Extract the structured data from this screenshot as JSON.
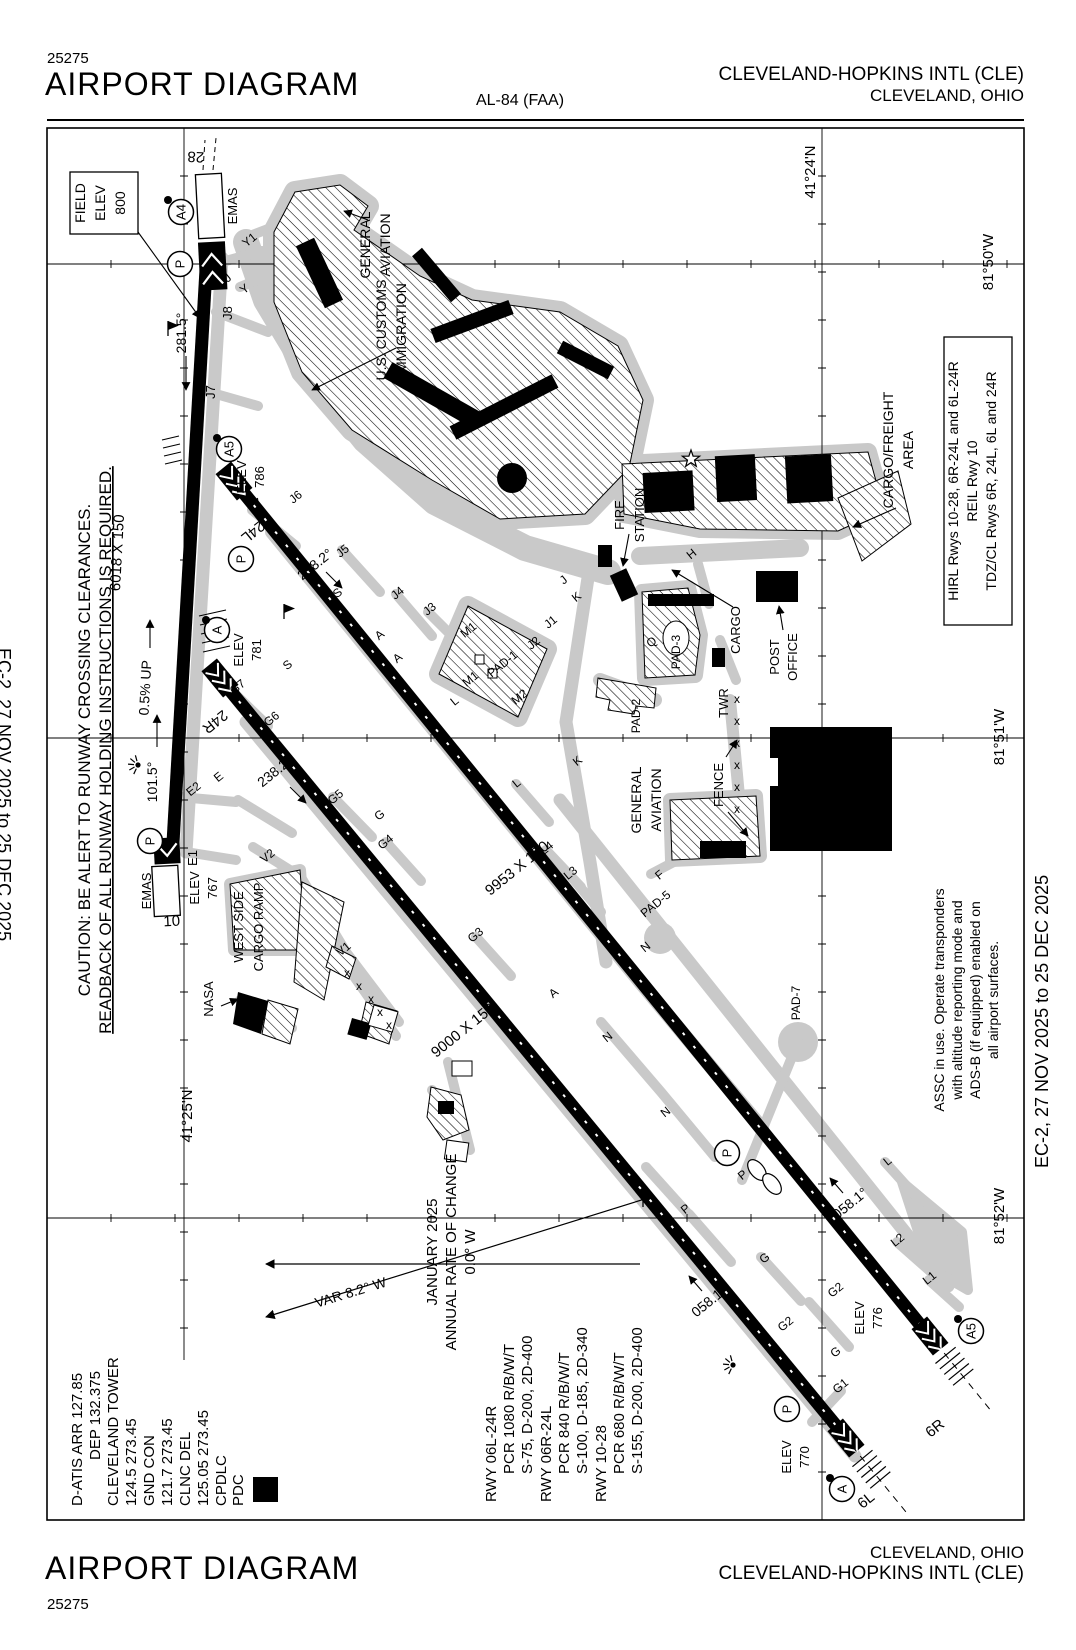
{
  "header": {
    "chart_number": "25275",
    "title": "AIRPORT DIAGRAM",
    "procedure": "AL-84 (FAA)",
    "airport": "CLEVELAND-HOPKINS INTL (CLE)",
    "city": "CLEVELAND, OHIO"
  },
  "footer": {
    "title": "AIRPORT DIAGRAM",
    "chart_number": "25275",
    "city": "CLEVELAND, OHIO",
    "airport": "CLEVELAND-HOPKINS INTL (CLE)"
  },
  "margins": {
    "left": "EC-2,  27 NOV 2025  to  25 DEC 2025",
    "right": "EC-2,  27 NOV 2025  to  25 DEC 2025"
  },
  "caution": {
    "lines": [
      {
        "t": "CAUTION: BE ALERT TO RUNWAY CROSSING CLEARANCES.",
        "x": 90,
        "y": 750,
        "fs": 17
      },
      {
        "t": "READBACK OF ALL RUNWAY HOLDING INSTRUCTIONS IS REQUIRED.",
        "x": 111,
        "y": 750,
        "fs": 17,
        "u": true
      }
    ]
  },
  "comms": {
    "lines": [
      {
        "t": "D-ATIS ARR 127.85",
        "x": 82,
        "y": 1506,
        "a": "s",
        "fs": 15
      },
      {
        "t": "DEP 132.375",
        "x": 100,
        "y": 1460,
        "a": "s",
        "fs": 15
      },
      {
        "t": "CLEVELAND TOWER",
        "x": 118,
        "y": 1506,
        "a": "s",
        "fs": 15
      },
      {
        "t": "124.5  273.45",
        "x": 136,
        "y": 1506,
        "a": "s",
        "fs": 15
      },
      {
        "t": "GND CON",
        "x": 154,
        "y": 1506,
        "a": "s",
        "fs": 15
      },
      {
        "t": "121.7  273.45",
        "x": 172,
        "y": 1506,
        "a": "s",
        "fs": 15
      },
      {
        "t": "CLNC DEL",
        "x": 190,
        "y": 1506,
        "a": "s",
        "fs": 15
      },
      {
        "t": "125.05  273.45",
        "x": 208,
        "y": 1506,
        "a": "s",
        "fs": 15
      },
      {
        "t": "CPDLC",
        "x": 226,
        "y": 1506,
        "a": "s",
        "fs": 15
      },
      {
        "t": "PDC",
        "x": 243,
        "y": 1506,
        "a": "s",
        "fs": 15
      }
    ],
    "pdc_symbol": "D"
  },
  "runway_data": {
    "lines": [
      {
        "t": "RWY 06L-24R",
        "x": 496,
        "y": 1502,
        "a": "s",
        "fs": 15
      },
      {
        "t": "PCR 1080 R/B/W/T",
        "x": 514,
        "y": 1474,
        "a": "s",
        "fs": 15
      },
      {
        "t": "S-75, D-200, 2D-400",
        "x": 532,
        "y": 1474,
        "a": "s",
        "fs": 15
      },
      {
        "t": "RWY 06R-24L",
        "x": 551,
        "y": 1502,
        "a": "s",
        "fs": 15
      },
      {
        "t": "PCR 840 R/B/W/T",
        "x": 569,
        "y": 1474,
        "a": "s",
        "fs": 15
      },
      {
        "t": "S-100, D-185, 2D-340",
        "x": 587,
        "y": 1474,
        "a": "s",
        "fs": 15
      },
      {
        "t": "RWY 10-28",
        "x": 606,
        "y": 1502,
        "a": "s",
        "fs": 15
      },
      {
        "t": "PCR 680 R/B/W/T",
        "x": 624,
        "y": 1474,
        "a": "s",
        "fs": 15
      },
      {
        "t": "S-155, D-200, 2D-400",
        "x": 642,
        "y": 1474,
        "a": "s",
        "fs": 15
      }
    ]
  },
  "variation": {
    "lines": [
      {
        "t": "JANUARY 2025",
        "x": 437,
        "y": 1252,
        "fs": 15
      },
      {
        "t": "ANNUAL RATE OF CHANGE",
        "x": 456,
        "y": 1252,
        "fs": 15
      },
      {
        "t": "0.0° W",
        "x": 475,
        "y": 1252,
        "fs": 15
      },
      {
        "t": "VAR 8.2° W",
        "x": 352,
        "y": 1297,
        "r": -17,
        "fs": 14
      }
    ]
  },
  "lighting": {
    "lines": [
      {
        "t": "HIRL Rwys 10-28, 6R-24L and 6L-24R",
        "x": 958,
        "y": 481,
        "fs": 14
      },
      {
        "t": "REIL Rwy 10",
        "x": 977,
        "y": 481,
        "fs": 14
      },
      {
        "t": "TDZ/CL Rwys 6R, 24L, 6L and 24R",
        "x": 996,
        "y": 481,
        "fs": 14
      }
    ]
  },
  "assc": {
    "lines": [
      {
        "t": "ASSC in use. Operate transponders",
        "x": 944,
        "y": 1000,
        "fs": 14
      },
      {
        "t": "with altitude reporting mode and",
        "x": 962,
        "y": 1000,
        "fs": 14
      },
      {
        "t": "ADS-B (if equipped) enabled on",
        "x": 980,
        "y": 1000,
        "fs": 14
      },
      {
        "t": "all airport surfaces.",
        "x": 998,
        "y": 1000,
        "fs": 14
      }
    ]
  },
  "field_elev": {
    "lines": [
      {
        "t": "FIELD",
        "x": 85,
        "y": 203,
        "fs": 14
      },
      {
        "t": "ELEV",
        "x": 105,
        "y": 203,
        "fs": 14
      },
      {
        "t": "800",
        "x": 125,
        "y": 203,
        "fs": 14
      }
    ]
  },
  "map_labels": [
    {
      "t": "28",
      "x": 196,
      "y": 152,
      "r": 183,
      "fs": 15
    },
    {
      "t": "EMAS",
      "x": 237,
      "y": 206,
      "fs": 13
    },
    {
      "t": "J8",
      "x": 232,
      "y": 313,
      "fs": 13
    },
    {
      "t": "J7",
      "x": 215,
      "y": 392,
      "fs": 13
    },
    {
      "t": "Y1",
      "x": 252,
      "y": 243,
      "r": -39,
      "fs": 12
    },
    {
      "t": "J",
      "x": 230,
      "y": 281,
      "r": -39,
      "fs": 12
    },
    {
      "t": "Y",
      "x": 247,
      "y": 292,
      "r": -39,
      "fs": 12
    },
    {
      "t": "281.5°",
      "x": 186,
      "y": 333,
      "fs": 14
    },
    {
      "t": "GENERAL",
      "x": 370,
      "y": 245,
      "fs": 14
    },
    {
      "t": "AVIATION",
      "x": 390,
      "y": 245,
      "fs": 14
    },
    {
      "t": "U.S. CUSTOMS",
      "x": 386,
      "y": 330,
      "fs": 14
    },
    {
      "t": "IMMIGRATION",
      "x": 406,
      "y": 330,
      "fs": 14
    },
    {
      "t": "ELEV",
      "x": 246,
      "y": 477,
      "fs": 13
    },
    {
      "t": "786",
      "x": 264,
      "y": 477,
      "fs": 13
    },
    {
      "t": "L7",
      "x": 258,
      "y": 508,
      "r": -39,
      "fs": 12
    },
    {
      "t": "24L",
      "x": 250,
      "y": 528,
      "r": 141,
      "fs": 15
    },
    {
      "t": "238.2°",
      "x": 318,
      "y": 568,
      "r": -39,
      "fs": 14
    },
    {
      "t": "J6",
      "x": 298,
      "y": 500,
      "r": -39,
      "fs": 12
    },
    {
      "t": "J5",
      "x": 345,
      "y": 554,
      "r": -39,
      "fs": 12
    },
    {
      "t": "J4",
      "x": 400,
      "y": 596,
      "r": -39,
      "fs": 12
    },
    {
      "t": "J3",
      "x": 432,
      "y": 612,
      "r": -39,
      "fs": 12
    },
    {
      "t": "S",
      "x": 340,
      "y": 596,
      "r": -39,
      "fs": 12
    },
    {
      "t": "S",
      "x": 290,
      "y": 668,
      "r": -39,
      "fs": 12
    },
    {
      "t": "6018 X 150",
      "x": 122,
      "y": 553,
      "r": -87,
      "fs": 15
    },
    {
      "t": "0.5% UP",
      "x": 150,
      "y": 688,
      "r": -87,
      "fs": 14
    },
    {
      "t": "ELEV",
      "x": 243,
      "y": 650,
      "fs": 13
    },
    {
      "t": "781",
      "x": 261,
      "y": 650,
      "fs": 13
    },
    {
      "t": "G7",
      "x": 240,
      "y": 690,
      "r": -39,
      "fs": 12
    },
    {
      "t": "24R",
      "x": 212,
      "y": 718,
      "r": 141,
      "fs": 15
    },
    {
      "t": "G6",
      "x": 274,
      "y": 722,
      "r": -39,
      "fs": 12
    },
    {
      "t": "238.2°",
      "x": 278,
      "y": 775,
      "r": -39,
      "fs": 14
    },
    {
      "t": "G5",
      "x": 338,
      "y": 800,
      "r": -39,
      "fs": 12
    },
    {
      "t": "G",
      "x": 382,
      "y": 818,
      "r": -39,
      "fs": 12
    },
    {
      "t": "E2",
      "x": 196,
      "y": 792,
      "r": -39,
      "fs": 12
    },
    {
      "t": "E",
      "x": 221,
      "y": 780,
      "r": -39,
      "fs": 12
    },
    {
      "t": "101.5°",
      "x": 157,
      "y": 782,
      "fs": 14
    },
    {
      "t": "EMAS",
      "x": 151,
      "y": 891,
      "fs": 13
    },
    {
      "t": "E1",
      "x": 197,
      "y": 858,
      "fs": 13
    },
    {
      "t": "ELEV",
      "x": 199,
      "y": 888,
      "fs": 13
    },
    {
      "t": "767",
      "x": 217,
      "y": 888,
      "fs": 13
    },
    {
      "t": "10",
      "x": 172,
      "y": 926,
      "r": -3,
      "fs": 15
    },
    {
      "t": "V2",
      "x": 270,
      "y": 859,
      "r": -39,
      "fs": 12
    },
    {
      "t": "WEST SIDE",
      "x": 243,
      "y": 927,
      "fs": 13
    },
    {
      "t": "CARGO RAMP",
      "x": 263,
      "y": 927,
      "fs": 13
    },
    {
      "t": "V1",
      "x": 346,
      "y": 952,
      "r": -39,
      "fs": 12
    },
    {
      "t": "NASA",
      "x": 213,
      "y": 999,
      "fs": 13
    },
    {
      "t": "9000 X 150",
      "x": 466,
      "y": 1034,
      "r": -39,
      "fs": 15
    },
    {
      "t": "9953 X 150",
      "x": 520,
      "y": 872,
      "r": -39,
      "fs": 15
    },
    {
      "t": "G4",
      "x": 388,
      "y": 845,
      "r": -39,
      "fs": 12
    },
    {
      "t": "G3",
      "x": 478,
      "y": 938,
      "r": -39,
      "fs": 12
    },
    {
      "t": "L4",
      "x": 549,
      "y": 851,
      "r": -39,
      "fs": 12
    },
    {
      "t": "L3",
      "x": 573,
      "y": 876,
      "r": -39,
      "fs": 12
    },
    {
      "t": "L",
      "x": 519,
      "y": 786,
      "r": -39,
      "fs": 12
    },
    {
      "t": "L",
      "x": 457,
      "y": 704,
      "r": -39,
      "fs": 12
    },
    {
      "t": "K",
      "x": 579,
      "y": 600,
      "r": -39,
      "fs": 12
    },
    {
      "t": "K",
      "x": 580,
      "y": 764,
      "r": -39,
      "fs": 12
    },
    {
      "t": "J",
      "x": 566,
      "y": 583,
      "r": -39,
      "fs": 12
    },
    {
      "t": "J2",
      "x": 536,
      "y": 646,
      "r": -39,
      "fs": 12
    },
    {
      "t": "J1",
      "x": 553,
      "y": 625,
      "r": -39,
      "fs": 12
    },
    {
      "t": "M1",
      "x": 471,
      "y": 633,
      "r": -39,
      "fs": 12
    },
    {
      "t": "M1",
      "x": 473,
      "y": 682,
      "r": -39,
      "fs": 12
    },
    {
      "t": "PAD-1",
      "x": 505,
      "y": 667,
      "r": -39,
      "fs": 12
    },
    {
      "t": "M2",
      "x": 522,
      "y": 700,
      "r": -39,
      "fs": 12
    },
    {
      "t": "PAD-2",
      "x": 640,
      "y": 716,
      "fs": 12
    },
    {
      "t": "PAD-3",
      "x": 680,
      "y": 652,
      "fs": 12
    },
    {
      "t": "Q",
      "x": 654,
      "y": 645,
      "r": -39,
      "fs": 12
    },
    {
      "t": "FIRE",
      "x": 624,
      "y": 515,
      "fs": 13
    },
    {
      "t": "STATION",
      "x": 644,
      "y": 515,
      "fs": 13
    },
    {
      "t": "H",
      "x": 694,
      "y": 557,
      "r": -39,
      "fs": 12
    },
    {
      "t": "CARGO",
      "x": 740,
      "y": 630,
      "fs": 13
    },
    {
      "t": "TWR",
      "x": 728,
      "y": 703,
      "fs": 13
    },
    {
      "t": "POST",
      "x": 779,
      "y": 657,
      "fs": 13
    },
    {
      "t": "OFFICE",
      "x": 797,
      "y": 657,
      "fs": 13
    },
    {
      "t": "CARGO/FREIGHT",
      "x": 893,
      "y": 450,
      "fs": 14
    },
    {
      "t": "AREA",
      "x": 913,
      "y": 450,
      "fs": 14
    },
    {
      "t": "GENERAL",
      "x": 641,
      "y": 800,
      "fs": 14
    },
    {
      "t": "AVIATION",
      "x": 661,
      "y": 800,
      "fs": 14
    },
    {
      "t": "FENCE",
      "x": 723,
      "y": 785,
      "fs": 13
    },
    {
      "t": "F",
      "x": 662,
      "y": 878,
      "r": -39,
      "fs": 12
    },
    {
      "t": "PAD-5",
      "x": 658,
      "y": 907,
      "r": -39,
      "fs": 12
    },
    {
      "t": "N",
      "x": 648,
      "y": 950,
      "r": -39,
      "fs": 12
    },
    {
      "t": "N",
      "x": 610,
      "y": 1040,
      "r": -39,
      "fs": 12
    },
    {
      "t": "N",
      "x": 668,
      "y": 1115,
      "r": -39,
      "fs": 12
    },
    {
      "t": "A",
      "x": 382,
      "y": 638,
      "r": -39,
      "fs": 12
    },
    {
      "t": "A",
      "x": 400,
      "y": 661,
      "r": -39,
      "fs": 12
    },
    {
      "t": "A",
      "x": 556,
      "y": 996,
      "r": -39,
      "fs": 12
    },
    {
      "t": "PAD-7",
      "x": 800,
      "y": 1003,
      "fs": 12
    },
    {
      "t": "L",
      "x": 890,
      "y": 1164,
      "r": -39,
      "fs": 12
    },
    {
      "t": "058.1°",
      "x": 853,
      "y": 1207,
      "r": -39,
      "fs": 14
    },
    {
      "t": "L2",
      "x": 900,
      "y": 1243,
      "r": -39,
      "fs": 12
    },
    {
      "t": "L1",
      "x": 932,
      "y": 1281,
      "r": -39,
      "fs": 12
    },
    {
      "t": "058.1°",
      "x": 712,
      "y": 1305,
      "r": -39,
      "fs": 14
    },
    {
      "t": "G",
      "x": 767,
      "y": 1261,
      "r": -39,
      "fs": 12
    },
    {
      "t": "G2",
      "x": 788,
      "y": 1327,
      "r": -39,
      "fs": 12
    },
    {
      "t": "G2",
      "x": 838,
      "y": 1293,
      "r": -39,
      "fs": 12
    },
    {
      "t": "G",
      "x": 838,
      "y": 1355,
      "r": -39,
      "fs": 12
    },
    {
      "t": "G1",
      "x": 843,
      "y": 1389,
      "r": -39,
      "fs": 12
    },
    {
      "t": "P",
      "x": 745,
      "y": 1178,
      "r": -39,
      "fs": 12
    },
    {
      "t": "P",
      "x": 688,
      "y": 1212,
      "r": -39,
      "fs": 12
    },
    {
      "t": "ELEV",
      "x": 864,
      "y": 1318,
      "fs": 13
    },
    {
      "t": "776",
      "x": 882,
      "y": 1318,
      "fs": 13
    },
    {
      "t": "ELEV",
      "x": 791,
      "y": 1457,
      "fs": 13
    },
    {
      "t": "770",
      "x": 809,
      "y": 1457,
      "fs": 13
    },
    {
      "t": "6R",
      "x": 938,
      "y": 1432,
      "r": -39,
      "fs": 15
    },
    {
      "t": "6L",
      "x": 869,
      "y": 1504,
      "r": -39,
      "fs": 15
    },
    {
      "t": "41°24'N",
      "x": 815,
      "y": 172,
      "fs": 15
    },
    {
      "t": "41°25'N",
      "x": 192,
      "y": 1116,
      "fs": 15
    },
    {
      "t": "81°50'W",
      "x": 993,
      "y": 262,
      "fs": 15
    },
    {
      "t": "81°51'W",
      "x": 1004,
      "y": 737,
      "fs": 15
    },
    {
      "t": "81°52'W",
      "x": 1004,
      "y": 1216,
      "fs": 15
    }
  ],
  "circled_points": [
    {
      "t": "A4",
      "x": 181,
      "y": 212,
      "dx": 168,
      "dy": 200
    },
    {
      "t": "P",
      "x": 180,
      "y": 264
    },
    {
      "t": "A5",
      "x": 229,
      "y": 449,
      "dx": 217,
      "dy": 438
    },
    {
      "t": "P",
      "x": 241,
      "y": 559
    },
    {
      "t": "A",
      "x": 217,
      "y": 630,
      "dx": 206,
      "dy": 620
    },
    {
      "t": "P",
      "x": 150,
      "y": 841
    },
    {
      "t": "P",
      "x": 727,
      "y": 1153
    },
    {
      "t": "P",
      "x": 787,
      "y": 1409
    },
    {
      "t": "A5",
      "x": 971,
      "y": 1331,
      "dx": 958,
      "dy": 1319
    },
    {
      "t": "A",
      "x": 842,
      "y": 1489,
      "dx": 830,
      "dy": 1478
    }
  ],
  "icons": [
    {
      "type": "star",
      "x": 691,
      "y": 459
    },
    {
      "type": "light",
      "x": 138,
      "y": 765
    },
    {
      "type": "light",
      "x": 733,
      "y": 1365
    },
    {
      "type": "pennant",
      "x": 168,
      "y": 336
    },
    {
      "type": "pennant",
      "x": 284,
      "y": 619
    },
    {
      "type": "pennant",
      "x": 643,
      "y": 1207
    }
  ],
  "fence_marks": {
    "char": "x",
    "points": [
      {
        "x": 737,
        "y": 703
      },
      {
        "x": 737,
        "y": 725
      },
      {
        "x": 737,
        "y": 747
      },
      {
        "x": 737,
        "y": 769
      },
      {
        "x": 737,
        "y": 791
      },
      {
        "x": 737,
        "y": 813
      },
      {
        "x": 347,
        "y": 977
      },
      {
        "x": 359,
        "y": 990
      },
      {
        "x": 371,
        "y": 1003
      },
      {
        "x": 380,
        "y": 1016
      },
      {
        "x": 389,
        "y": 1029
      }
    ]
  }
}
